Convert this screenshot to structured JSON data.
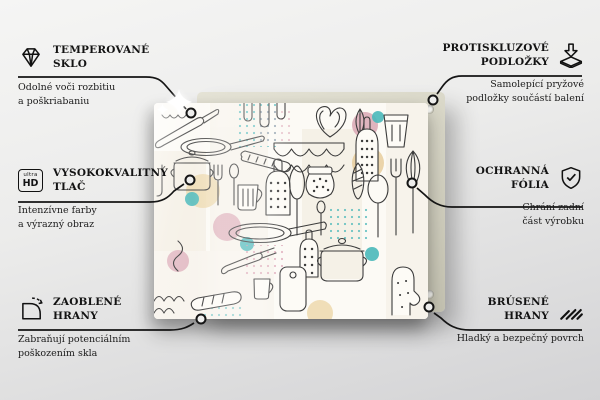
{
  "scene": {
    "type": "product-feature-infographic",
    "product": "glass kitchen board with doodle kitchen-utensils pattern",
    "colors": {
      "background_top": "#f5f5f4",
      "background_bottom": "#d3d3d5",
      "back_panel": "#d7d5c5",
      "glass_background": "#fcfaf5",
      "doodle_line": "#3b3b3b",
      "accent_teal": "#49b8ba",
      "accent_pink": "#d9a7b4",
      "accent_tan": "#e8cf9e",
      "callout_line": "#151515"
    }
  },
  "features": [
    {
      "id": "tempered-glass",
      "icon": "diamond-icon",
      "title1": "TEMPEROVANÉ",
      "title2": "SKLO",
      "desc1": "Odolné voči rozbitiu",
      "desc2": "a poškriabaniu"
    },
    {
      "id": "high-quality-print",
      "icon": "ultra-hd-icon",
      "title1": "VYSOKOKVALITNÝ",
      "title2": "TLAČ",
      "desc1": "Intenzívne farby",
      "desc2": "a výrazný obraz"
    },
    {
      "id": "rounded-edges",
      "icon": "rounded-corner-icon",
      "title1": "ZAOBLENÉ",
      "title2": "HRANY",
      "desc1": "Zabraňují potenciálním",
      "desc2": "poškozením skla"
    },
    {
      "id": "anti-slip-pads",
      "icon": "anti-slip-pad-icon",
      "title1": "PROTISKLUZOVÉ",
      "title2": "PODLOŽKY",
      "desc1": "Samolepící pryžové",
      "desc2": "podložky součástí balení"
    },
    {
      "id": "protective-film",
      "icon": "shield-check-icon",
      "title1": "OCHRANNÁ",
      "title2": "FÓLIA",
      "desc1": "Chrání zadní",
      "desc2": "část výrobku"
    },
    {
      "id": "ground-edges",
      "icon": "hatched-edge-icon",
      "title1": "BRÚSENÉ",
      "title2": "HRANY",
      "desc1": "Hladký a bezpečný povrch",
      "desc2": ""
    }
  ],
  "ultra_hd_icon": {
    "top": "ultra",
    "bottom": "HD"
  }
}
